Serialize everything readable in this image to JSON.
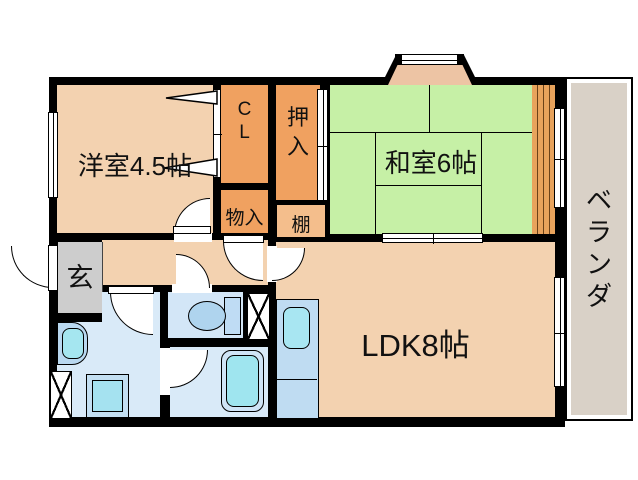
{
  "floorplan": {
    "rooms": {
      "western_room": {
        "label": "洋室4.5帖"
      },
      "japanese_room": {
        "label": "和室6帖"
      },
      "ldk": {
        "label": "LDK8帖"
      },
      "entrance": {
        "label": "玄"
      },
      "storage": {
        "label": "物入"
      },
      "shelf": {
        "label": "棚"
      },
      "closet_cl": {
        "chars": [
          "C",
          "L"
        ]
      },
      "oshiire": {
        "chars": [
          "押",
          "入"
        ]
      },
      "veranda": {
        "chars": [
          "ベ",
          "ラ",
          "ン",
          "ダ"
        ]
      }
    },
    "colors": {
      "wall": "#000000",
      "room_peach": "#F3D2B0",
      "closet_orange": "#F0A160",
      "shelf_orange": "#F4BE8C",
      "tatami_green": "#C6F0A6",
      "entrance_gray": "#CDCDCD",
      "wet_area_blue": "#D9EAF8",
      "tub_cyan": "#9FE5EF",
      "veranda_beige": "#D9D1C7",
      "wood_slat": "#E8A35C"
    }
  }
}
